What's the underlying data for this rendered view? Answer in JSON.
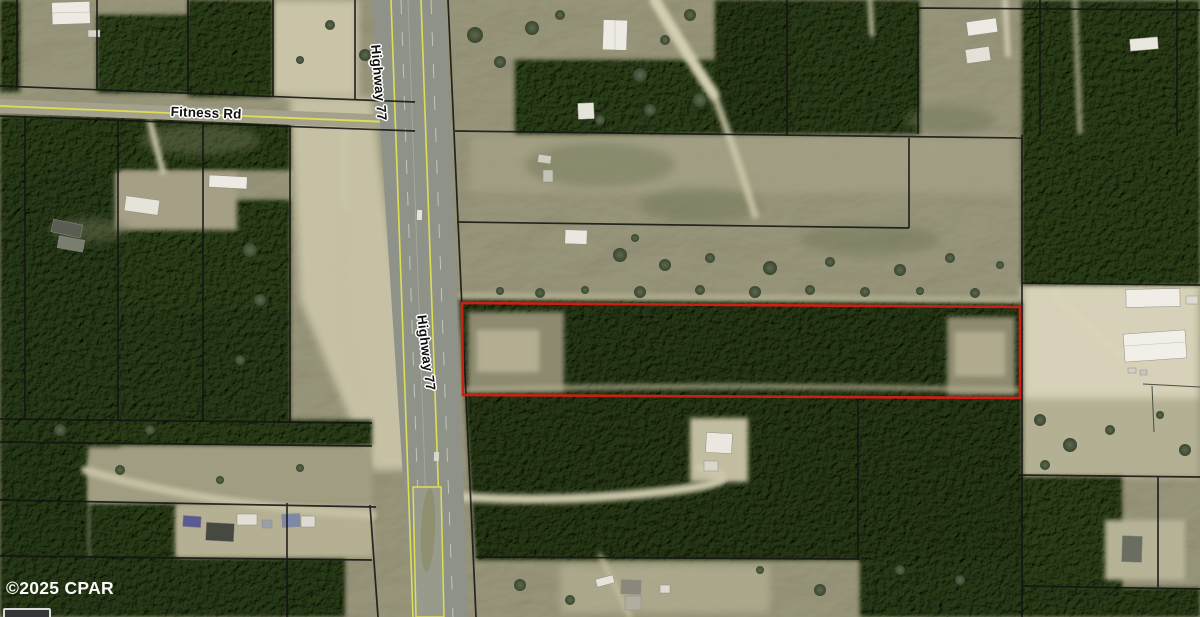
{
  "map": {
    "type": "aerial-parcel-map",
    "attribution": "©2025 CPAR",
    "road_labels": {
      "fitness_rd": "Fitness Rd",
      "highway_77": "Highway 77"
    },
    "colors": {
      "highlight_parcel": "#cc2016",
      "parcel_line": "#141414",
      "road_centerline_yellow": "#dede52",
      "field_olive": "#9a977c",
      "forest_green": "#46523a",
      "sand": "#cdc8ab",
      "highway_gray": "#8f9288"
    }
  }
}
